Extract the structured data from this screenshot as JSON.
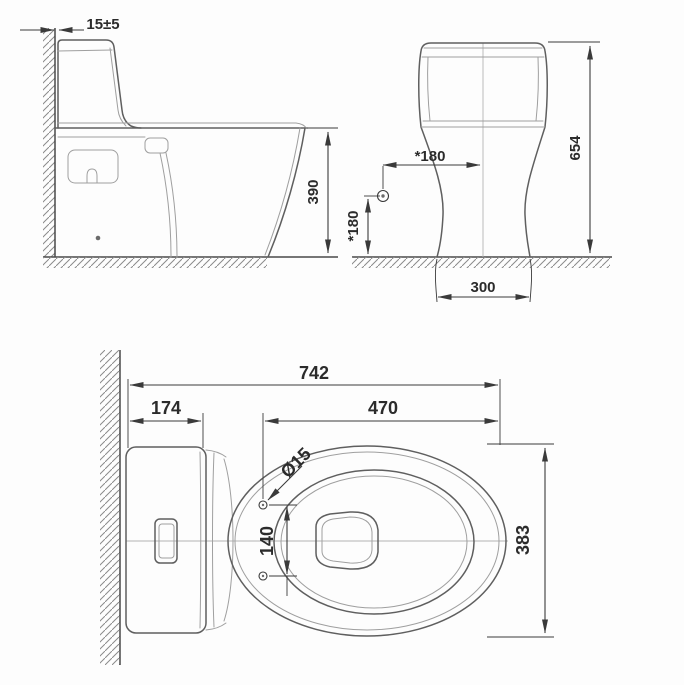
{
  "drawing": {
    "views": {
      "side": {
        "dimensions": {
          "wall_gap": "15±5",
          "bowl_height": "390"
        }
      },
      "front": {
        "dimensions": {
          "supply_horizontal": "*180",
          "supply_vertical": "*180",
          "total_height": "654",
          "base_width": "300"
        }
      },
      "plan": {
        "dimensions": {
          "total_length": "742",
          "tank_depth": "174",
          "seat_length": "470",
          "bolt_hole_diameter": "Ø15",
          "bolt_spacing": "140",
          "bowl_width": "383"
        }
      }
    },
    "colors": {
      "background": "#fdfdfd",
      "outline": "#5f5f5f",
      "detail": "#9f9f9f",
      "dimension": "#3a3a3a",
      "text": "#2b2b2b",
      "hatch": "#8a8a8a"
    }
  }
}
